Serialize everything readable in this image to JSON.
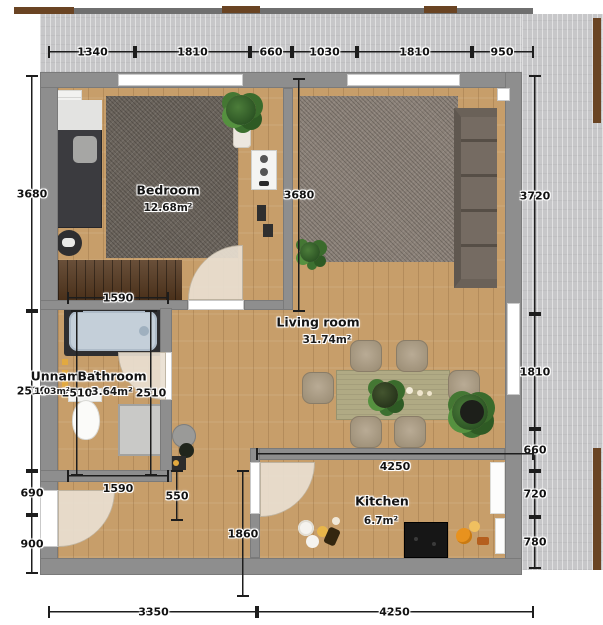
{
  "rooms": [
    {
      "name": "Bedroom",
      "area": "12.68m²"
    },
    {
      "name": "Living room",
      "area": "31.74m²"
    },
    {
      "name": "Kitchen",
      "area": "6.7m²"
    },
    {
      "name": "Bathroom",
      "area": "3.64m²"
    },
    {
      "name": "Unnamed",
      "area": "1.03m²"
    }
  ],
  "dims": {
    "top": [
      "1340",
      "1810",
      "660",
      "1030",
      "1810",
      "950"
    ],
    "left": [
      "3680",
      "2510",
      "690",
      "900"
    ],
    "right": [
      "3720",
      "1810",
      "660",
      "720",
      "780"
    ],
    "bottom": [
      "3350",
      "4250"
    ],
    "inner": {
      "living_height": "3680",
      "closet_width": "1590",
      "hall_width": "1590",
      "unnamed_height": "2510",
      "bath_height": "2510",
      "hall_kitchen_gap": "550",
      "kitchen_width": "4250",
      "kitchen_height": "1860"
    }
  },
  "colors": {
    "wood_floor": "#c79e6a",
    "wall": "#8e8e8e",
    "terrace": "#c7c7c9",
    "rail_wood": "#6a4423",
    "bedroom_rug": "#6b645c",
    "living_rug": "#8c8279",
    "bathtub": "#c4cfd9",
    "dining_table": "#b0aa84",
    "radiator_accent": "#e2a93f"
  }
}
